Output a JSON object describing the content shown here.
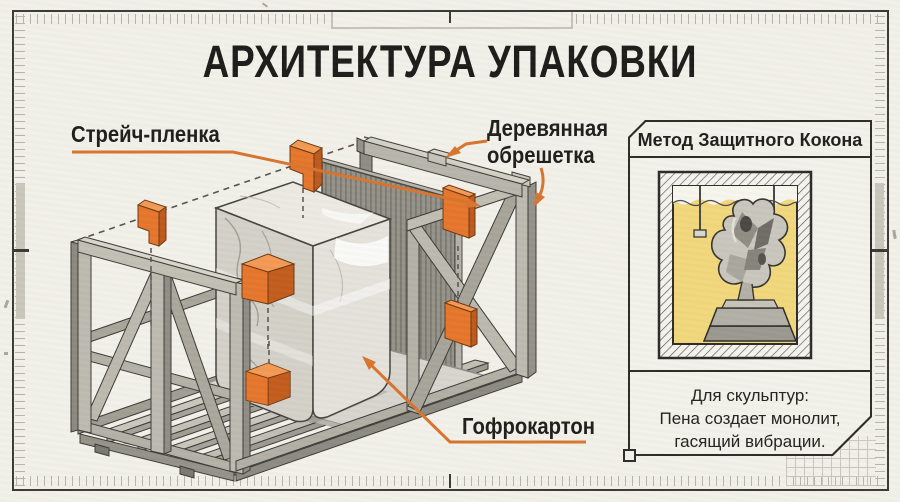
{
  "title": "АРХИТЕКТУРА УПАКОВКИ",
  "callouts": {
    "stretch_film": "Стрейч-пленка",
    "wooden_crate_line1": "Деревянная",
    "wooden_crate_line2": "обрешетка",
    "cardboard": "Гофрокартон"
  },
  "side_panel": {
    "header": "Метод Защитного Кокона",
    "caption_line1": "Для скульптур:",
    "caption_line2": "Пена создает монолит,",
    "caption_line3": "гасящий вибрации."
  },
  "colors": {
    "background": "#f1f0e9",
    "ink": "#211f1c",
    "accent_orange": "#d8742e",
    "frame": "#3a3935",
    "foam_yellow": "#f1d77b",
    "wood": "#b2afa5",
    "cardboard_gray": "#95928a",
    "marble": "#e4e2da"
  }
}
